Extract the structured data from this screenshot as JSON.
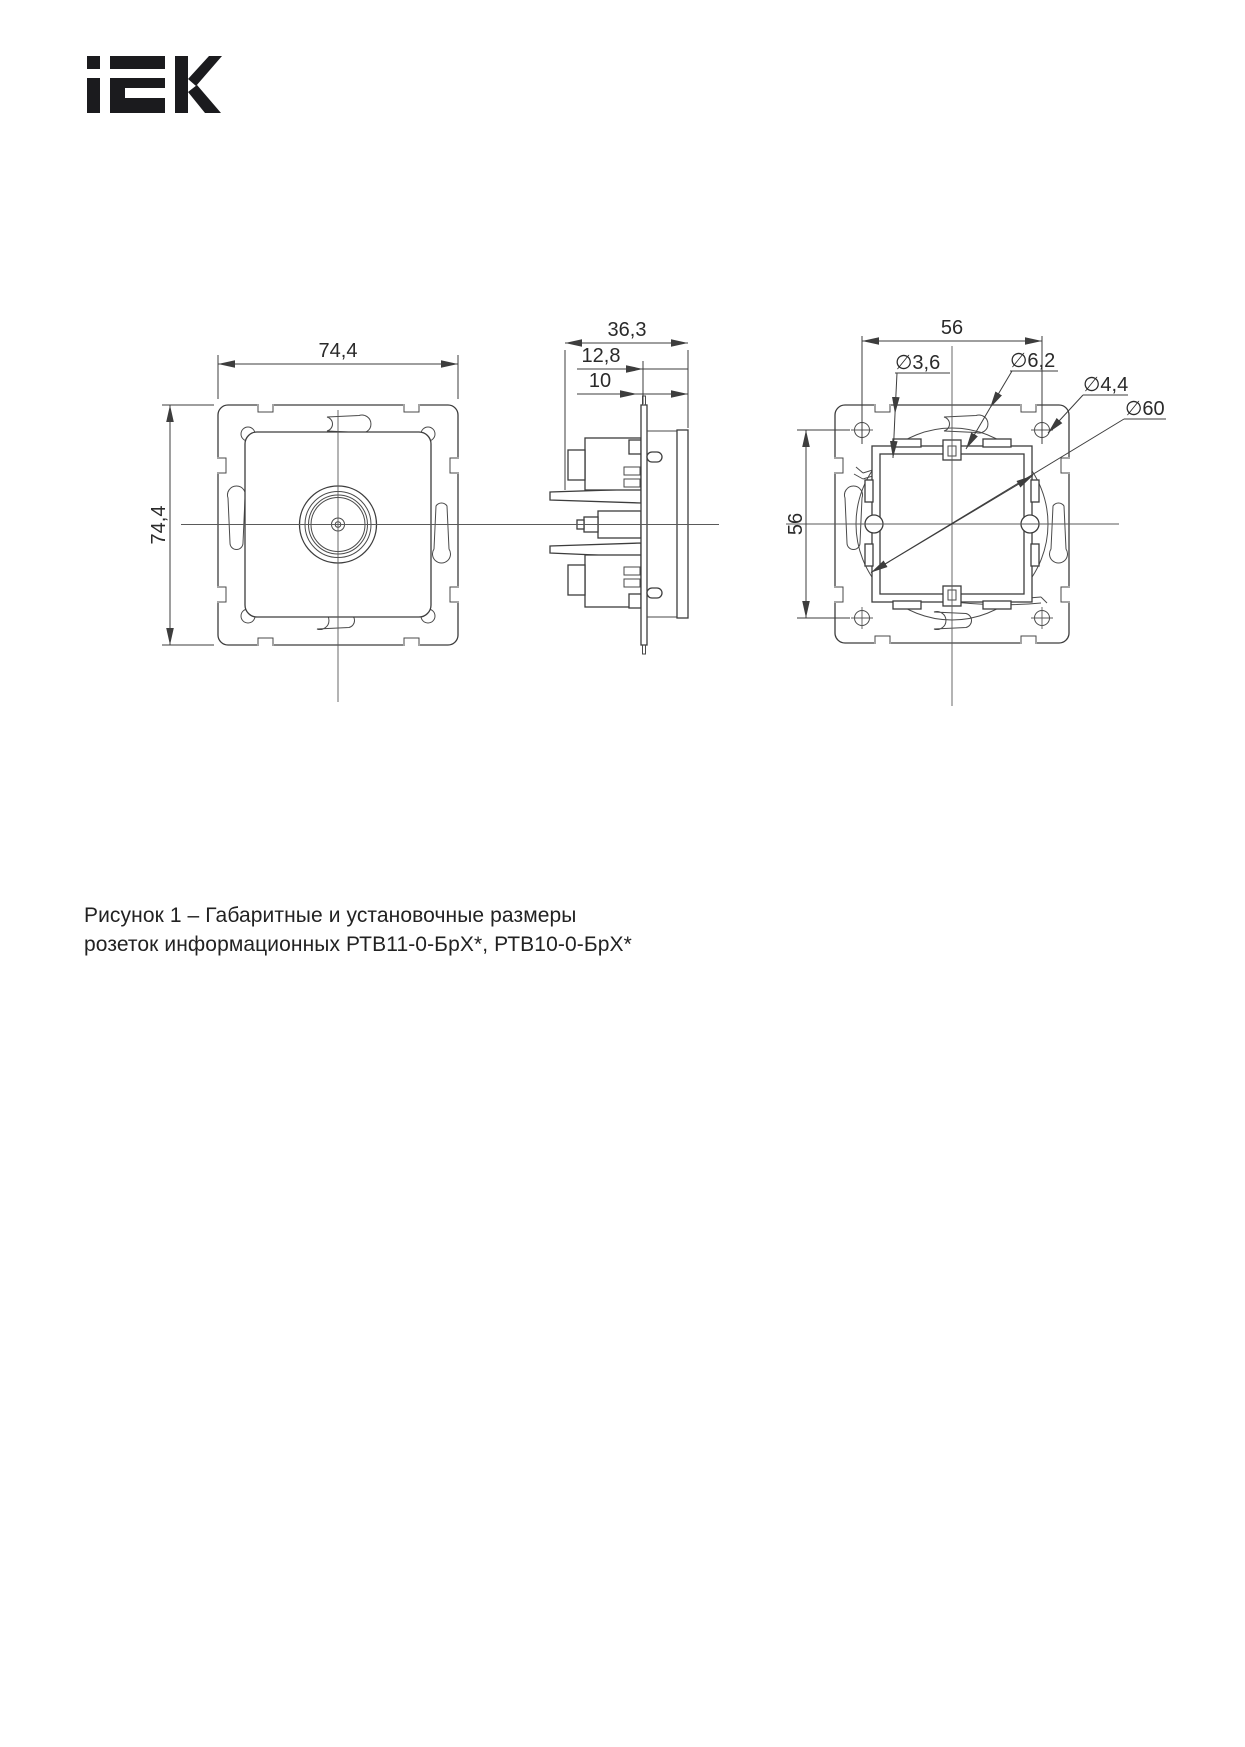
{
  "brand": {
    "name": "IEK"
  },
  "drawing": {
    "front": {
      "dim_width": "74,4",
      "dim_height": "74,4"
    },
    "side": {
      "dim_depth": "36,3",
      "dim_mid": "12,8",
      "dim_inner": "10"
    },
    "back": {
      "dim_h": "56",
      "dim_v": "56",
      "dia_claw": "∅3,6",
      "dia_slot": "∅6,2",
      "dia_screw": "∅4,4",
      "dia_mount": "∅60"
    }
  },
  "caption": {
    "line1": "Рисунок 1 – Габаритные и установочные размеры",
    "line2": "розеток информационных РТВ11-0-БрХ*, РТВ10-0-БрХ*"
  },
  "colors": {
    "line": "#3d3d3d",
    "text": "#2a2a2a",
    "logo": "#1b1b1e",
    "background": "#ffffff"
  }
}
